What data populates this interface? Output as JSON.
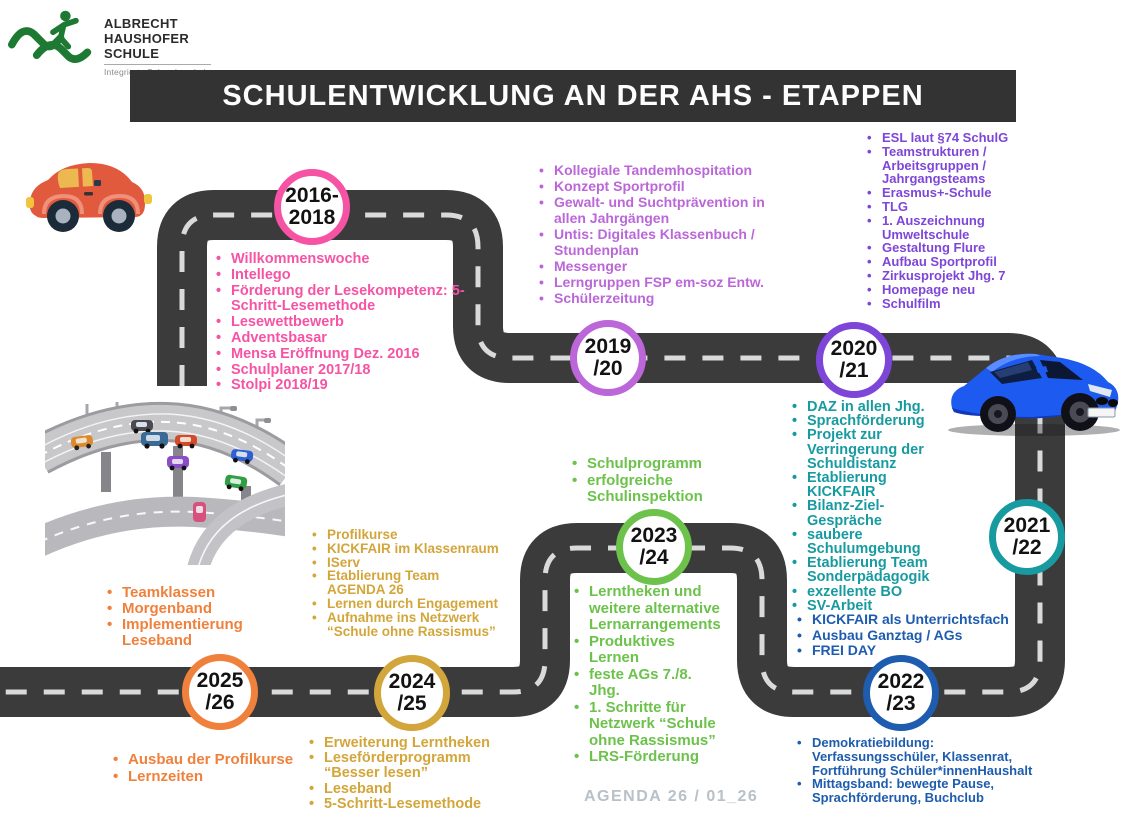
{
  "logo": {
    "name_lines": [
      "ALBRECHT",
      "HAUSHOFER",
      "SCHULE"
    ],
    "subtitle": "Integrierte Sekundarschule"
  },
  "banner": {
    "title": "SCHULENTWICKLUNG AN DER AHS - ETAPPEN"
  },
  "footer": {
    "label": "AGENDA 26 / 01_26"
  },
  "colors": {
    "road": "#3b3b3b",
    "road_dash": "#dadada",
    "banner_bg": "#333333",
    "logo_green": "#1e7a33",
    "footer_gray": "#b8c0c8"
  },
  "milestones": [
    {
      "id": "2016-2018",
      "year_top": "2016-",
      "year_bottom": "2018",
      "color": "#f653a4",
      "items": [
        "Willkommenswoche",
        "Intellego",
        "Förderung der Lesekompetenz: 5-Schritt-Lesemethode",
        "Lesewettbewerb",
        "Adventsbasar",
        "Mensa Eröffnung Dez. 2016",
        "Schulplaner 2017/18",
        "Stolpi 2018/19"
      ]
    },
    {
      "id": "2019-20",
      "year_top": "2019",
      "year_bottom": "/20",
      "color": "#bb66d9",
      "items": [
        "Kollegiale Tandemhospitation",
        "Konzept Sportprofil",
        "Gewalt- und Suchtprävention in allen Jahrgängen",
        "Untis: Digitales Klassenbuch / Stundenplan",
        "Messenger",
        "Lerngruppen FSP em-soz Entw.",
        "Schülerzeitung"
      ]
    },
    {
      "id": "2020-21",
      "year_top": "2020",
      "year_bottom": "/21",
      "color": "#7e46d8",
      "items": [
        "ESL laut §74 SchulG",
        "Teamstrukturen / Arbeitsgruppen / Jahrgangsteams",
        "Erasmus+-Schule",
        "TLG",
        "1. Auszeichnung Umweltschule",
        "Gestaltung Flure",
        "Aufbau Sportprofil",
        "Zirkusprojekt Jhg. 7",
        "Homepage neu",
        "Schulfilm"
      ]
    },
    {
      "id": "2021-22",
      "year_top": "2021",
      "year_bottom": "/22",
      "color": "#179ba0",
      "items": [
        "DAZ in allen Jhg.",
        "Sprachförderung",
        "Projekt zur Verringerung der Schuldistanz",
        "Etablierung KICKFAIR",
        "Bilanz-Ziel-Gespräche",
        "saubere Schulumgebung",
        "Etablierung Team Sonderpädagogik",
        "exzellente BO",
        "SV-Arbeit"
      ]
    },
    {
      "id": "2022-23",
      "year_top": "2022",
      "year_bottom": "/23",
      "color": "#1d5cae",
      "items_above": [
        "KICKFAIR als Unterrichtsfach",
        "Ausbau Ganztag / AGs",
        "FREI DAY"
      ],
      "items_below": [
        "Demokratiebildung: Verfassungsschüler, Klassenrat, Fortführung Schüler*innenHaushalt",
        "Mittagsband: bewegte Pause, Sprachförderung, Buchclub"
      ]
    },
    {
      "id": "2023-24",
      "year_top": "2023",
      "year_bottom": "/24",
      "color": "#6cc24b",
      "items_above": [
        "Schulprogramm",
        "erfolgreiche Schulinspektion"
      ],
      "items_below": [
        "Lerntheken und weitere alternative Lernarrangements",
        "Produktives Lernen",
        "feste AGs 7./8. Jhg.",
        "1. Schritte  für Netzwerk “Schule ohne Rassismus”",
        "LRS-Förderung"
      ]
    },
    {
      "id": "2024-25",
      "year_top": "2024",
      "year_bottom": "/25",
      "color": "#d3a63b",
      "items_above": [
        "Profilkurse",
        "KICKFAIR im Klassenraum",
        "IServ",
        "Etablierung Team AGENDA 26",
        "Lernen durch Engagement",
        "Aufnahme ins Netzwerk “Schule ohne Rassismus”"
      ],
      "items_below": [
        "Erweiterung Lerntheken",
        "Leseförderprogramm “Besser lesen”",
        "Leseband",
        "5-Schritt-Lesemethode"
      ]
    },
    {
      "id": "2025-26",
      "year_top": "2025",
      "year_bottom": "/26",
      "color": "#f0813c",
      "items_above": [
        "Teamklassen",
        "Morgenband",
        "Implementierung Leseband"
      ],
      "items_below": [
        "Ausbau der Profilkurse",
        "Lernzeiten"
      ]
    }
  ]
}
